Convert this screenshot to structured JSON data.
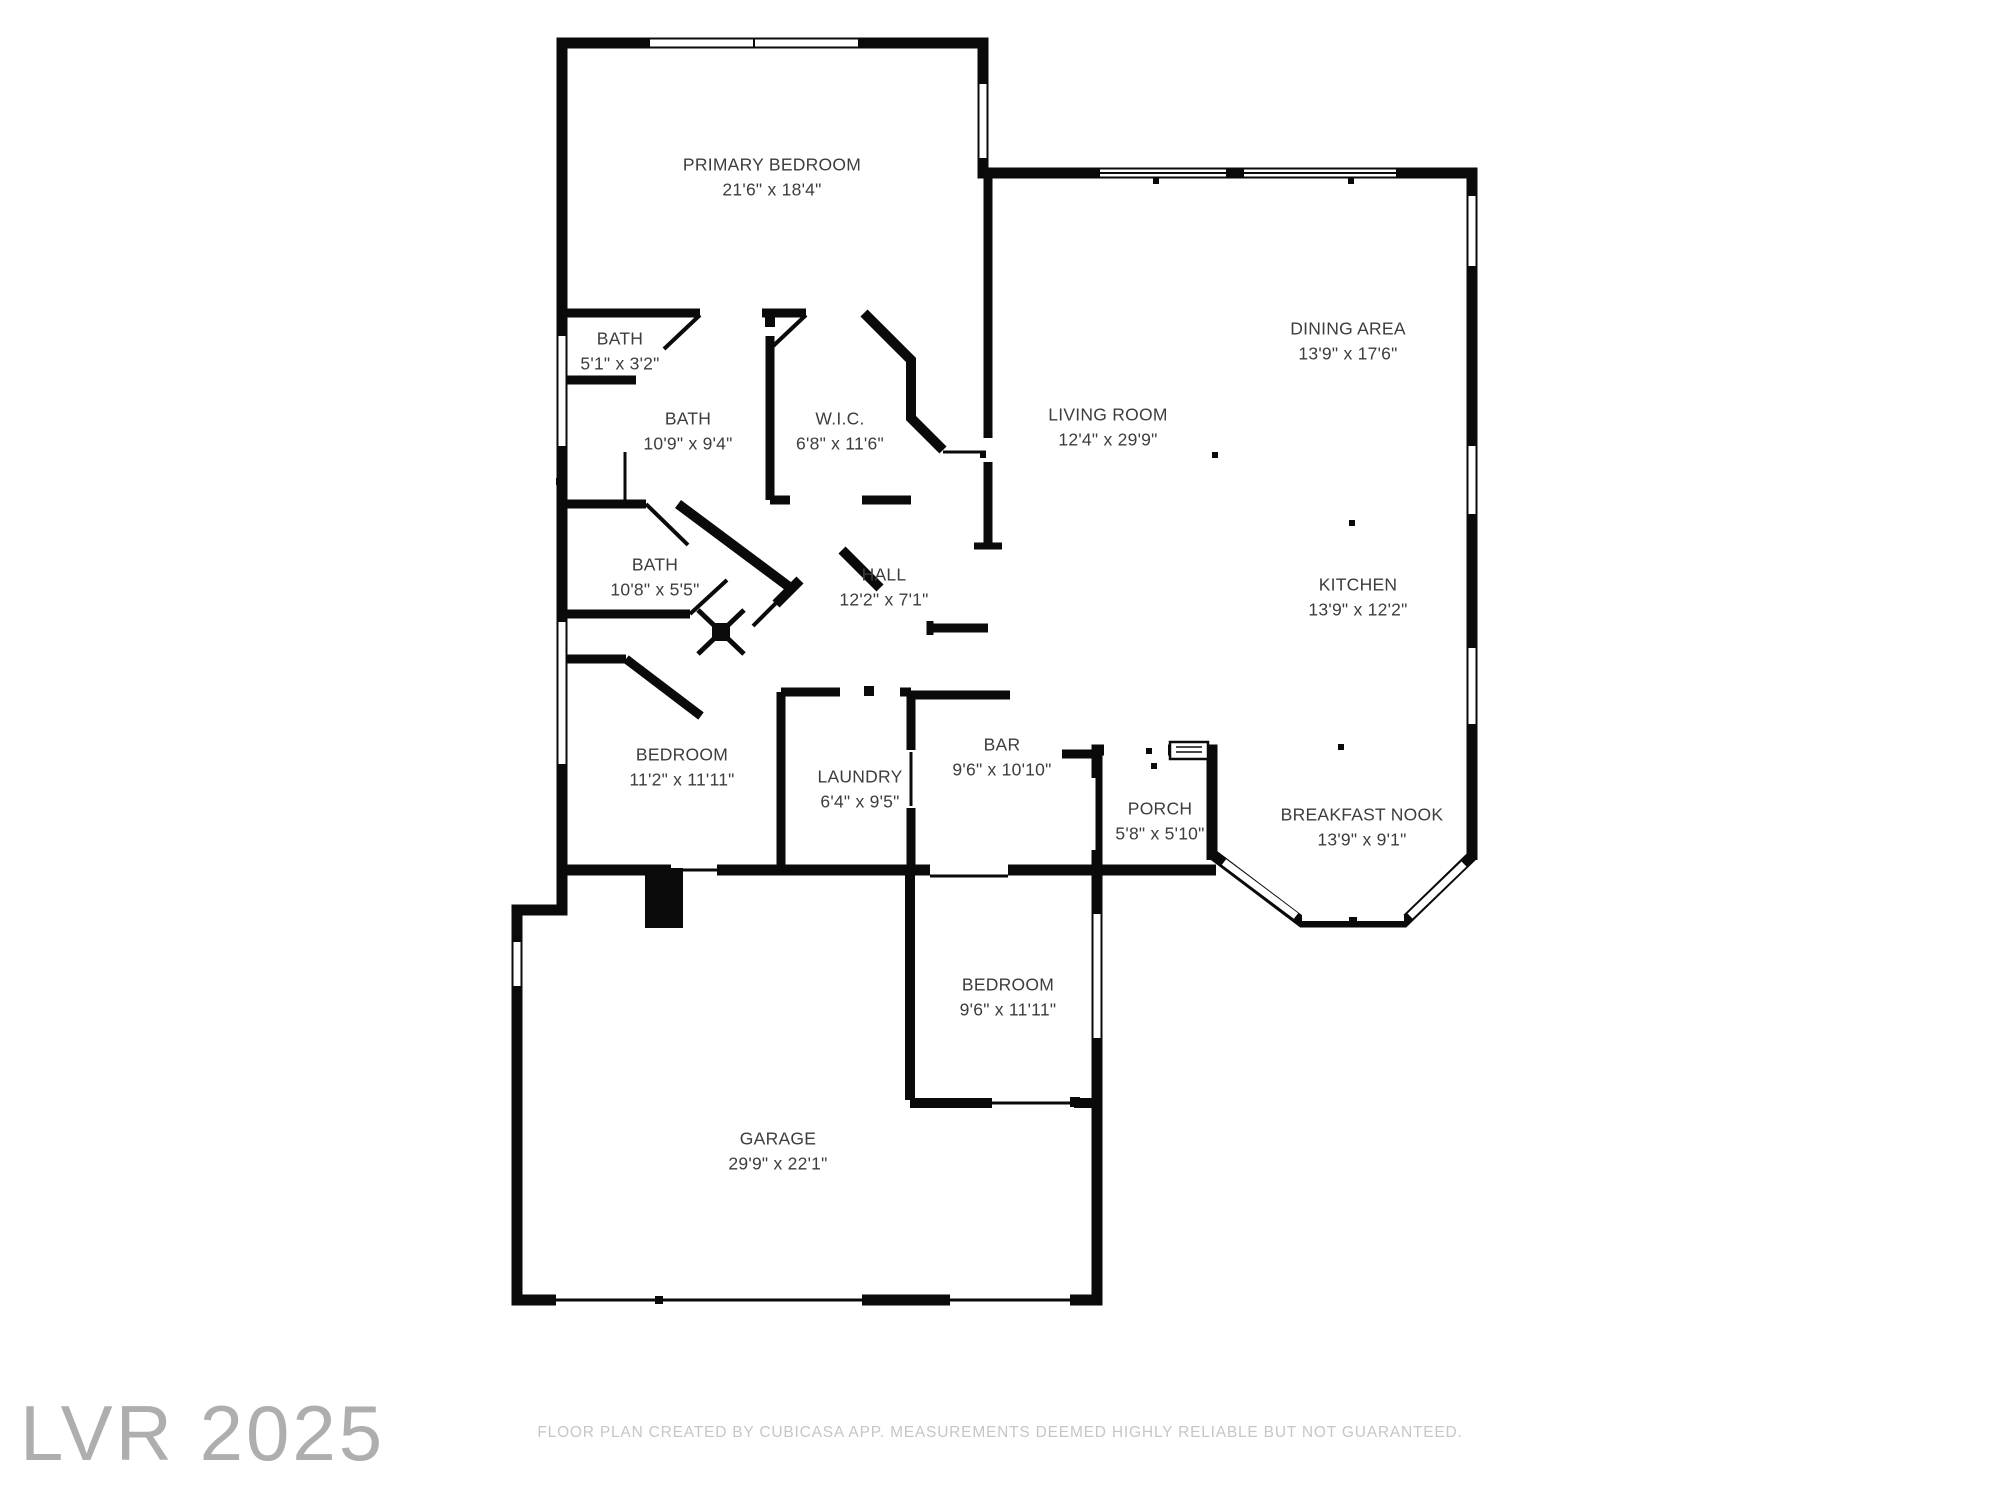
{
  "rooms": [
    {
      "name": "PRIMARY BEDROOM",
      "dims": "21'6\" x 18'4\""
    },
    {
      "name": "BATH",
      "dims": "5'1\" x 3'2\""
    },
    {
      "name": "BATH",
      "dims": "10'9\" x 9'4\""
    },
    {
      "name": "W.I.C.",
      "dims": "6'8\" x 11'6\""
    },
    {
      "name": "LIVING ROOM",
      "dims": "12'4\" x 29'9\""
    },
    {
      "name": "DINING AREA",
      "dims": "13'9\" x 17'6\""
    },
    {
      "name": "BATH",
      "dims": "10'8\" x 5'5\""
    },
    {
      "name": "HALL",
      "dims": "12'2\" x 7'1\""
    },
    {
      "name": "KITCHEN",
      "dims": "13'9\" x 12'2\""
    },
    {
      "name": "BEDROOM",
      "dims": "11'2\" x 11'11\""
    },
    {
      "name": "LAUNDRY",
      "dims": "6'4\" x 9'5\""
    },
    {
      "name": "BAR",
      "dims": "9'6\" x 10'10\""
    },
    {
      "name": "PORCH",
      "dims": "5'8\" x 5'10\""
    },
    {
      "name": "BREAKFAST NOOK",
      "dims": "13'9\" x 9'1\""
    },
    {
      "name": "BEDROOM",
      "dims": "9'6\" x 11'11\""
    },
    {
      "name": "GARAGE",
      "dims": "29'9\" x 22'1\""
    }
  ],
  "watermark": "LVR 2025",
  "footer": {
    "text": "FLOOR PLAN CREATED BY CUBICASA APP. MEASUREMENTS DEEMED HIGHLY RELIABLE BUT NOT GUARANTEED."
  },
  "colors": {
    "wall": "#0a0a0a",
    "label_text": "#3d3d3d",
    "watermark": "#aeaeae",
    "footer": "#c6c6c6"
  }
}
